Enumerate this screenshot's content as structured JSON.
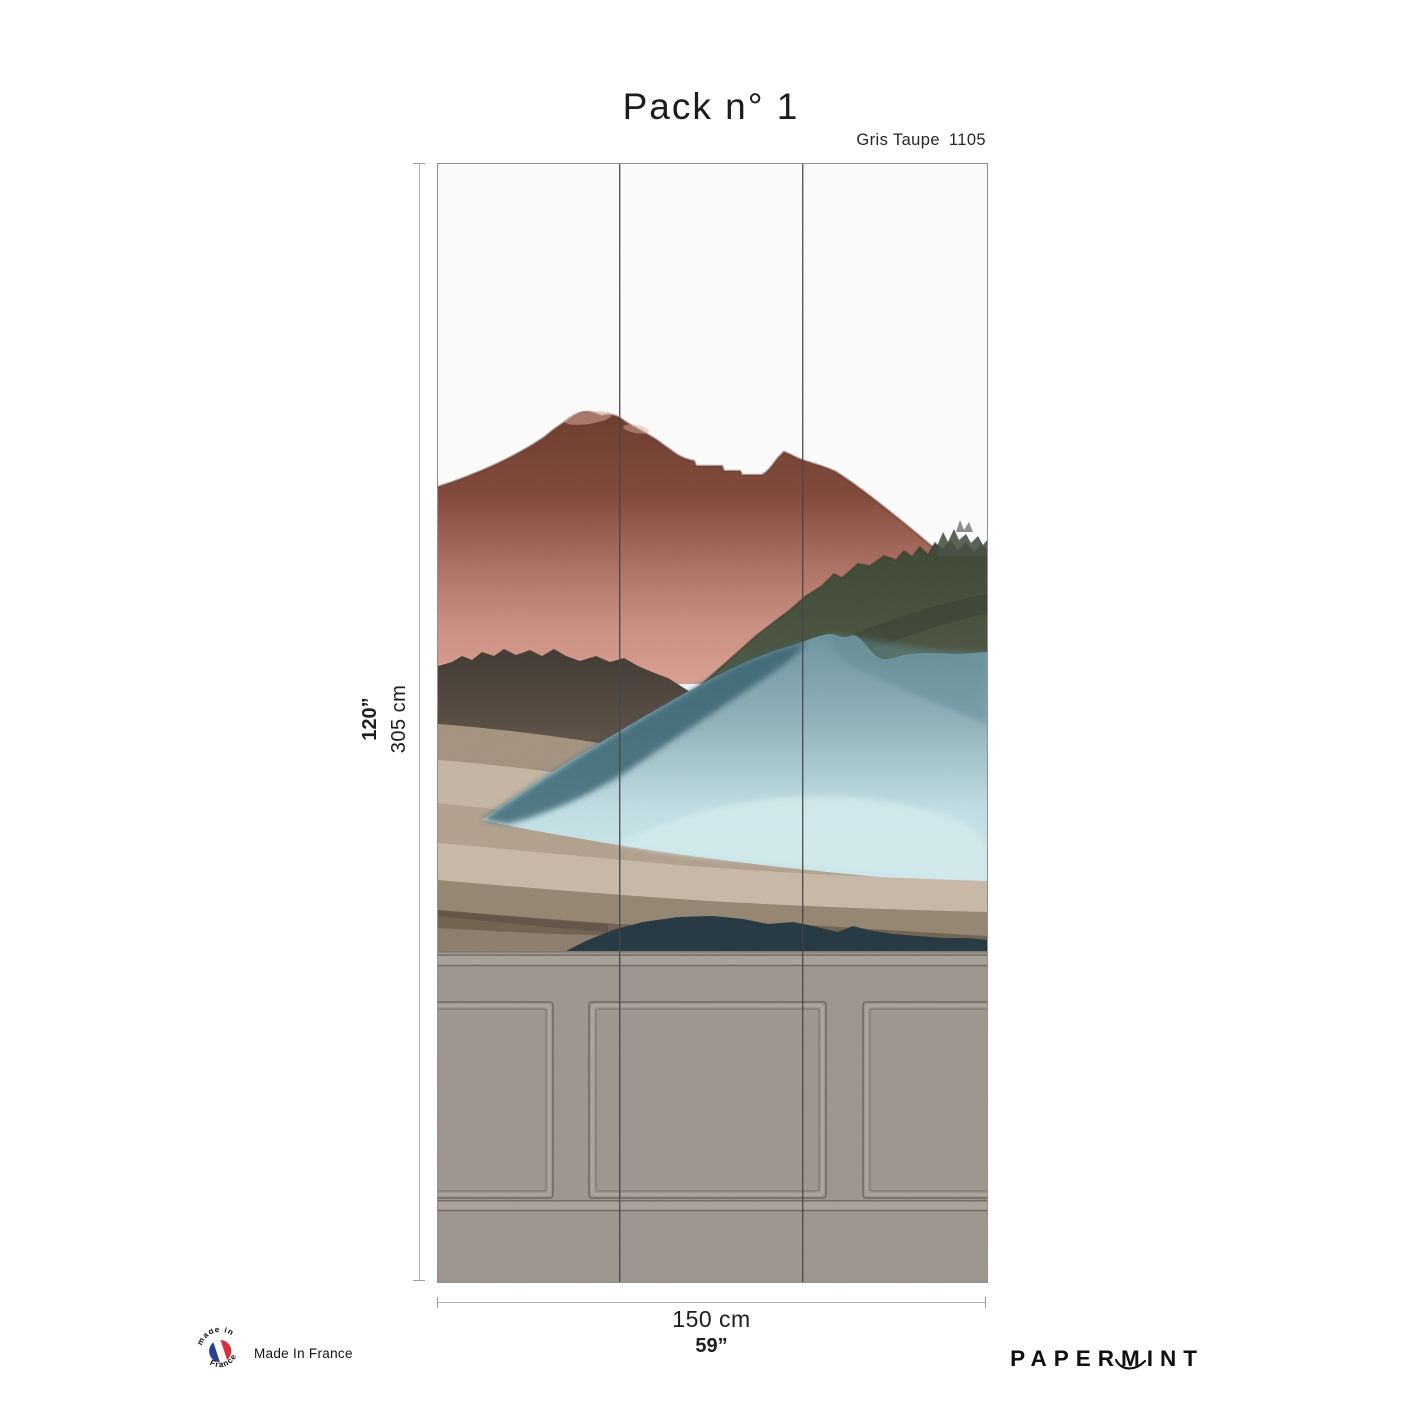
{
  "header": {
    "title": "Pack n° 1",
    "colorway_name": "Gris Taupe",
    "colorway_code": "1105"
  },
  "wallpaper": {
    "strips": 3,
    "description": "Watercolor mountain landscape mural above grey wainscot paneling",
    "colors": {
      "sky": "#ffffff",
      "mountain_brick_dark": "#693828",
      "mountain_salmon": "#d99f90",
      "mountain_olive": "#49533d",
      "mountain_steel_blue": "#8fb2ba",
      "mountain_ice_blue": "#cfe9ed",
      "mountain_teal_dark": "#2e5b69",
      "hills_taupe": "#a4917e",
      "hills_beige": "#c6b5a3",
      "hills_dark_brown": "#6e5e4d",
      "ridge_navy": "#1f323d",
      "wainscot_grey": "#9b958c",
      "wainscot_line": "#6d6760"
    }
  },
  "dimensions": {
    "height_inches": "120”",
    "height_cm": "305 cm",
    "width_cm": "150 cm",
    "width_inches": "59”"
  },
  "footer": {
    "made_in_france": "Made In France",
    "badge_text_top": "made in",
    "badge_text_bottom": "France",
    "badge_flag_blue": "#2c3f94",
    "badge_flag_red": "#d72f3f",
    "brand": "PAPERMINT"
  }
}
